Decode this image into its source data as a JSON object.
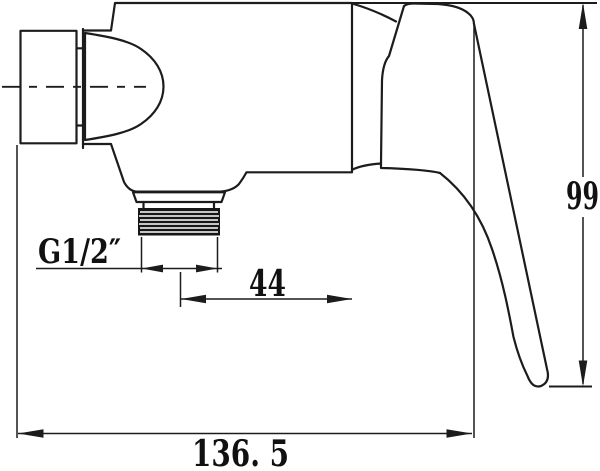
{
  "meta": {
    "background_color": "#ffffff",
    "line_color": "#1c1c1c",
    "text_color": "#111111",
    "description": "Technical side-elevation drawing of a wall-mounted single-lever shower mixer valve with dimension annotations"
  },
  "drawing": {
    "labels": {
      "thread_size": "G1/2″",
      "outlet_offset": "44",
      "body_height": "99",
      "overall_width": "136. 5"
    }
  }
}
